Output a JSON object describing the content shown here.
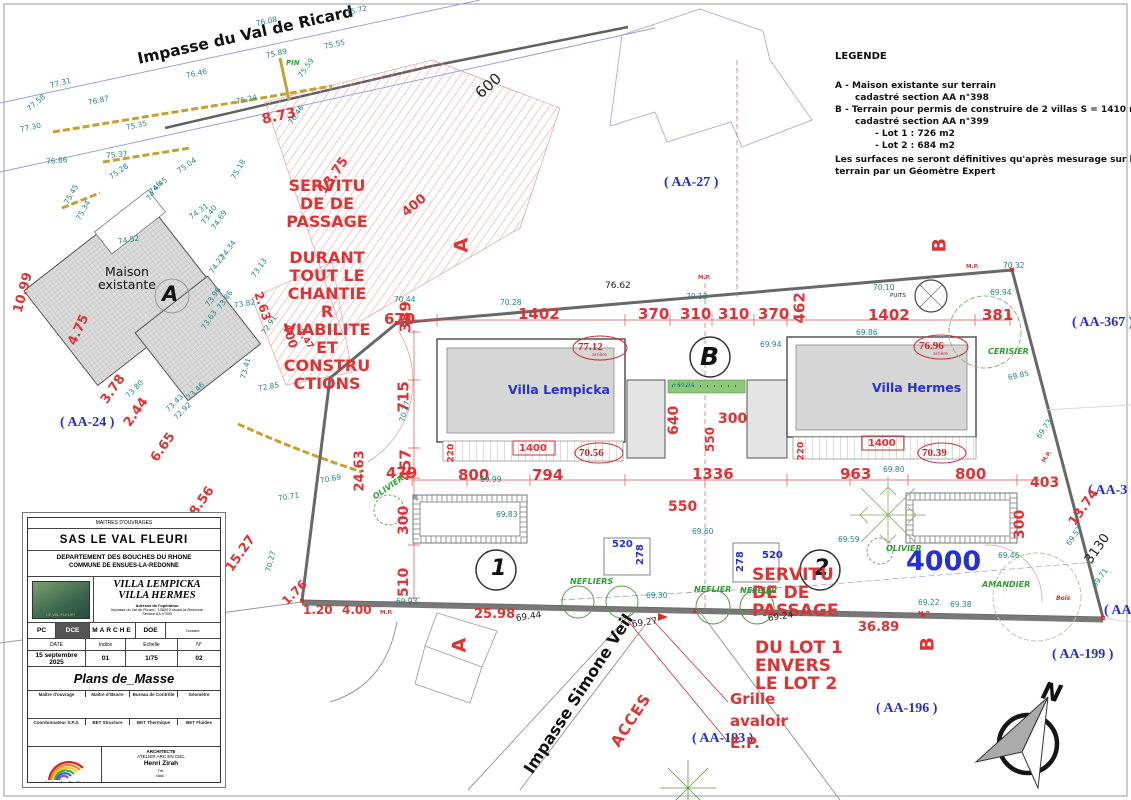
{
  "legend": {
    "title": "LEGENDE",
    "line_a1": "A - Maison existante sur terrain",
    "line_a2": "cadastré section AA n°398",
    "line_b1": "B - Terrain pour permis de construire de 2 villas S = 1410 m2",
    "line_b2": "cadastré section AA n°399",
    "lot1": "- Lot 1 : 726 m2",
    "lot2": "- Lot 2 : 684 m2",
    "note1": "Les surfaces ne seront définitives qu'après mesurage sur le",
    "note2": "terrain par un Géomètre Expert"
  },
  "streets": {
    "ricard": "Impasse du Val de Ricard",
    "veil": "Impasse Simone Veil",
    "acces": "ACCES"
  },
  "parcels": [
    "( AA-24 )",
    "( AA-27 )",
    "( AA-367 )",
    "( AA-3",
    "( AA",
    "( AA-199 )",
    "( AA-196 )",
    "( AA-193 )"
  ],
  "buildings": {
    "maison": "Maison existante",
    "maison_tag": "A",
    "villa1": "Villa Lempicka",
    "villa2": "Villa Hermes",
    "zone_tag": "B",
    "lot1_tag": "1",
    "lot2_tag": "2"
  },
  "section_markers": [
    "A",
    "B",
    "A",
    "B"
  ],
  "servitude_left": [
    "SERVITU",
    "DE DE",
    "PASSAGE",
    "DURANT",
    "TOUT LE",
    "CHANTIE",
    "R",
    "VIABILITE",
    "ET",
    "CONSTRU",
    "CTIONS"
  ],
  "servitude_right": [
    "SERVITU",
    "DE DE",
    "PASSAGE",
    "DU LOT 1",
    "ENVERS",
    "LE LOT 2"
  ],
  "grille": [
    "Grille",
    "avaloir",
    "E.P."
  ],
  "spot_red": [
    {
      "v": "77.12",
      "s": "arrière"
    },
    {
      "v": "70.56",
      "s": ""
    },
    {
      "v": "76.96",
      "s": "arrière"
    },
    {
      "v": "70.39",
      "s": ""
    }
  ],
  "dims_red": [
    "8.73",
    "13.75",
    "400",
    "2.63",
    "400",
    "3.47",
    "10.99",
    "4.75",
    "3.78",
    "2.44",
    "6.65",
    "8.56",
    "15.27",
    "1.76",
    "1.20",
    "4.00",
    "25.98",
    "36.89",
    "24.63",
    "479",
    "457",
    "670",
    "389",
    "715",
    "1402",
    "370",
    "310",
    "310",
    "370",
    "462",
    "1402",
    "381",
    "800",
    "794",
    "1336",
    "963",
    "800",
    "403",
    "300",
    "13.74",
    "220",
    "1400",
    "220",
    "1400",
    "640",
    "300",
    "550",
    "550",
    "300",
    "510"
  ],
  "dims_black": [
    "600",
    "76.62",
    "3130",
    "69.44",
    "69.27",
    "69.24"
  ],
  "dims_blue": [
    "520",
    "278",
    "278",
    "520",
    "4000"
  ],
  "elev": [
    "77.31",
    "77.58",
    "77.30",
    "76.87",
    "76.46",
    "76.86",
    "75.37",
    "75.28",
    "75.35",
    "75.45",
    "75.34",
    "75.24",
    "75.04",
    "74.45",
    "75.18",
    "76.46",
    "75.59",
    "76.08",
    "75.89",
    "75.72",
    "75.55",
    "74.52",
    "74.46",
    "74.31",
    "74.69",
    "73.40",
    "74.34",
    "74.22",
    "73.13",
    "73.82",
    "73.86",
    "73.96",
    "73.63",
    "72.91",
    "73.41",
    "72.85",
    "73.46",
    "73.43",
    "72.92",
    "73.80",
    "70.71",
    "70.69",
    "70.27",
    "69.93",
    "69.30",
    "69.60",
    "69.59",
    "69.80",
    "69.22",
    "69.38",
    "69.46",
    "69.52",
    "69.71",
    "69.73",
    "69.85",
    "69.94",
    "70.32",
    "70.44",
    "70.28",
    "70.13",
    "70.10",
    "69.94",
    "69.86",
    "69.99",
    "69.83",
    "70.27",
    "+69.94"
  ],
  "trees": [
    "PIN",
    "OLIVIER",
    "NEFLIERS",
    "NEFLIER",
    "NEFLIER",
    "OLIVIER",
    "CERISIER",
    "AMANDIER",
    "Bois"
  ],
  "misc": {
    "puits": "PUITS",
    "mp": "M.P.",
    "north": "N"
  },
  "titleblock": {
    "header": "MAITRES D'OUVRAGES",
    "client": "SAS LE VAL FLEURI",
    "dept": "DEPARTEMENT DES BOUCHES DU RHONE",
    "commune": "COMMUNE DE ENSUES-LA-REDONNE",
    "villa1": "VILLA LEMPICKA",
    "villa2": "VILLA HERMES",
    "addr_title": "Adresse de l'opération",
    "addr_line": "Impasse du Val de Ricard - 13820 Ensuès-la-Redonne",
    "addr_line2": "Section AA n°399",
    "thumb_caption": "LE VAL FLEURI",
    "phases": [
      "PC",
      "DCE",
      "MARCHE",
      "DOE"
    ],
    "dossier": "Dossier",
    "col_headers": [
      "DATE",
      "Indice",
      "Echelle",
      "N°"
    ],
    "col_values": [
      "15 septembre 2025",
      "01",
      "1/75",
      "02"
    ],
    "doc_title": "Plans de_Masse",
    "cells_row1": [
      "Maître d'ouvrage",
      "Maître d'Œuvre",
      "Bureau de Contrôle",
      "Géomètre"
    ],
    "cells_row2": [
      "Coordonnateur S.P.S.",
      "BET Structure",
      "BET Thermique",
      "BET Fluides"
    ],
    "logo": "Atelier Arc En Ciel",
    "arch_title": "ARCHITECTE",
    "arch_studio": "ATELIER ARC EN CIEL",
    "arch_name": "Henri Zirah",
    "arch_tel": "Tél.",
    "arch_mail": "Mail :"
  }
}
